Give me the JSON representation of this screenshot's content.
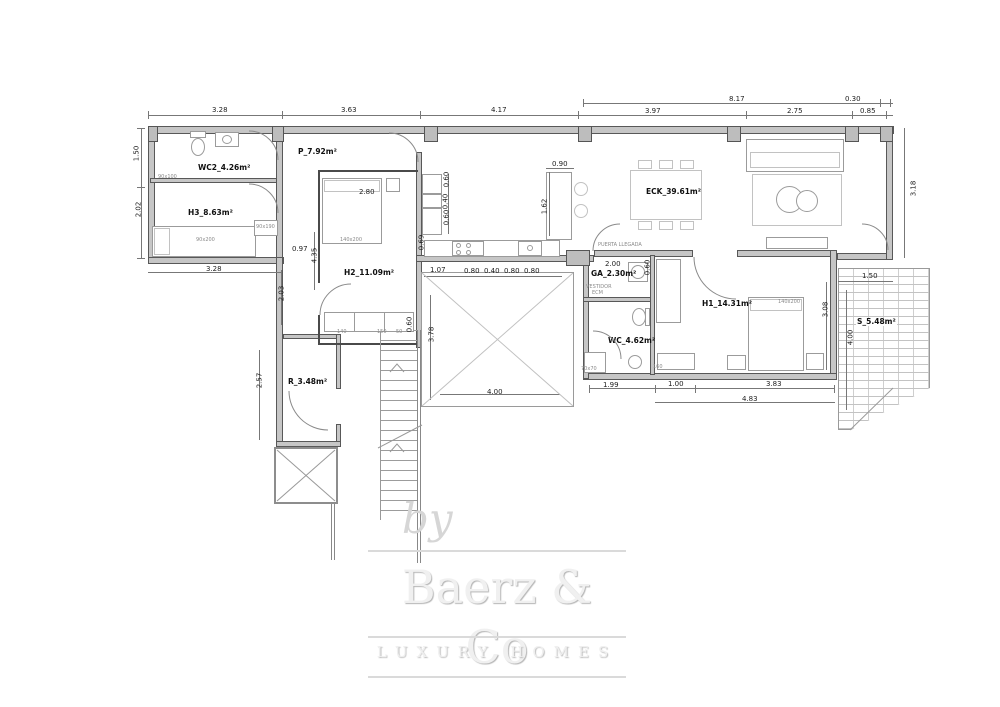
{
  "plan": {
    "rooms": {
      "wc2": "WC2_4.26m²",
      "h3": "H3_8.63m²",
      "p": "P_7.92m²",
      "h2": "H2_11.09m²",
      "r": "R_3.48m²",
      "eck": "ECK_39.61m²",
      "ga": "GA_2.30m²",
      "wc": "WC_4.62m²",
      "h1": "H1_14.31m²",
      "s": "S_5.48m²"
    },
    "notes": {
      "entrance": "PUERTA LLEGADA",
      "vestidor": "VESTIDOR",
      "ecm": "ECM",
      "wc2_fix": "90x100",
      "h3_bed": "90x200",
      "h3_closet": "90x190",
      "h2_bed": "140x200",
      "h1_bed": "140x200",
      "shower": "70x70",
      "d160": "160",
      "w140": "140",
      "w150": "150",
      "w50": "50"
    },
    "dims": [
      "8.17",
      "0.30",
      "3.28",
      "3.63",
      "4.17",
      "3.97",
      "2.75",
      "0.85",
      "1.50",
      "2.02",
      "3.28",
      "0.97",
      "4.35",
      "2.80",
      "2.03",
      "2.57",
      "0.60",
      "3.78",
      "4.00",
      "0.90",
      "1.62",
      "0.60",
      "0.40",
      "0.60",
      "0.69",
      "1.07",
      "0.80",
      "0.40",
      "0.80",
      "0.80",
      "3.18",
      "2.00",
      "0.60",
      "1.99",
      "1.00",
      "3.83",
      "4.83",
      "3.08",
      "4.00",
      "1.50"
    ]
  },
  "watermark": {
    "by": "by",
    "brand": "Baerz & Co",
    "tagline": "LUXURY HOMES"
  },
  "colors": {
    "wall_fill": "#c6c6c6",
    "line": "#585858",
    "dim_text": "#1c1c1c",
    "watermark": "#e9e9e9"
  }
}
